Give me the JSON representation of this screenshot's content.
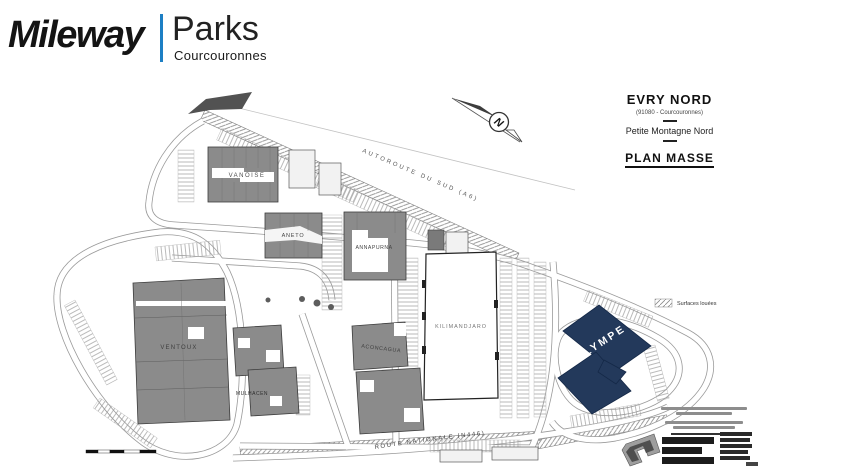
{
  "header": {
    "brand": "Mileway",
    "product": "Parks",
    "location": "Courcouronnes"
  },
  "title_block": {
    "site_name": "EVRY NORD",
    "site_code": "(91080 - Courcouronnes)",
    "zone": "Petite Montagne Nord",
    "plan_type": "PLAN MASSE"
  },
  "compass": {
    "north_label": "N"
  },
  "legend": {
    "leased_label": "Surfaces louées"
  },
  "roads": {
    "highway_label": "AUTOROUTE DU SUD (A6)",
    "national_label": "ROUTE NATIONALE (N446)"
  },
  "buildings": [
    {
      "name": "VANOISE",
      "highlighted": false
    },
    {
      "name": "ANETO",
      "highlighted": false
    },
    {
      "name": "ANNAPURNA",
      "highlighted": false
    },
    {
      "name": "KILIMANDJARO",
      "highlighted": false
    },
    {
      "name": "ACONCAGUA",
      "highlighted": false
    },
    {
      "name": "VENTOUX",
      "highlighted": false
    },
    {
      "name": "MULHACEN",
      "highlighted": false
    },
    {
      "name": "OLYMPE",
      "highlighted": true
    }
  ],
  "colors": {
    "brand_blue": "#1d7fc4",
    "building_gray": "#8b8b8b",
    "highlight_navy": "#23395b",
    "road_gray": "#9a9a9a"
  }
}
